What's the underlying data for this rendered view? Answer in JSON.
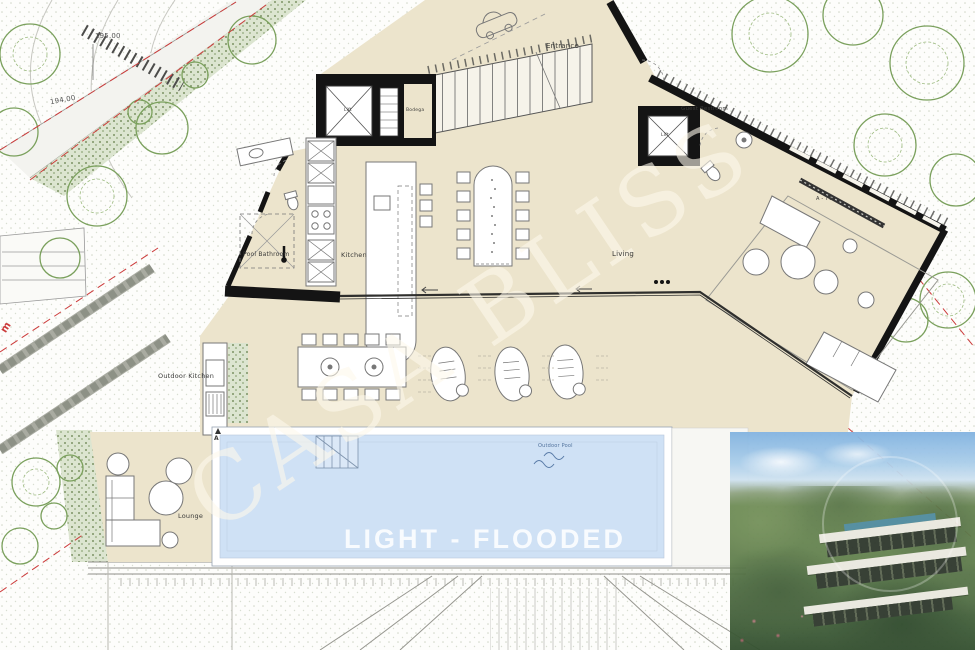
{
  "plan": {
    "watermark": "CASA BLISS",
    "tagline": "LIGHT - FLOODED",
    "rooms": {
      "entrance": "Entrance",
      "guest_restroom": "Guest Restroom",
      "pool_bathroom": "Pool Bathroom",
      "kitchen": "Kitchen",
      "living": "Living",
      "outdoor_kitchen": "Outdoor Kitchen",
      "lounge": "Lounge",
      "outdoor_pool": "Outdoor Pool",
      "bodega": "Bodega",
      "lift": "Lift",
      "tv_wall": "A - TV"
    },
    "annotations": {
      "elevation_upper": "195.00",
      "elevation_lower": "194.00",
      "street_fragment": "m",
      "section_marker": "A"
    },
    "colors": {
      "floor": "#ece4cc",
      "pool_water": "#cfe1f5",
      "wall": "#141414",
      "tree": "#7aa05c",
      "boundary_red": "#cc3b3b",
      "watermark": "#fdf8eb"
    }
  }
}
